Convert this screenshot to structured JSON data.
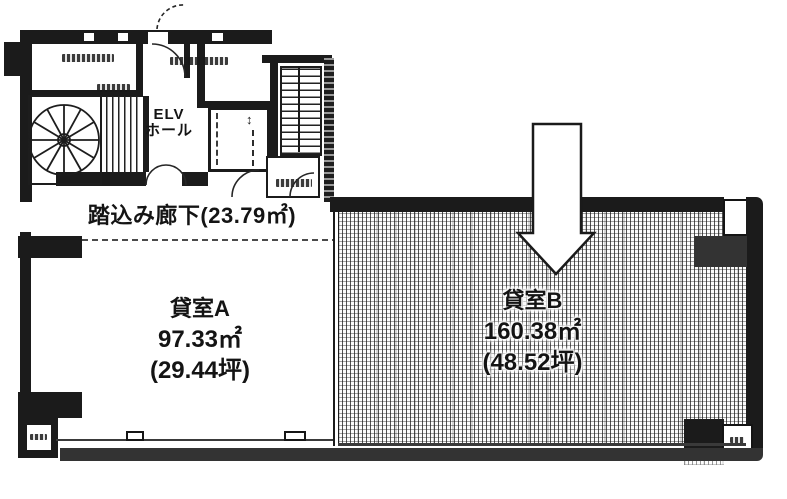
{
  "floorplan": {
    "core": {
      "elv_hall_line1": "ELV",
      "elv_hall_line2": "ホール",
      "elevator_symbol": "↕"
    },
    "corridor": {
      "label": "踏込み廊下(23.79㎡)"
    },
    "rooms": [
      {
        "id": "A",
        "name": "貸室A",
        "area_m2": "97.33㎡",
        "area_tsubo": "(29.44坪)"
      },
      {
        "id": "B",
        "name": "貸室B",
        "area_m2": "160.38㎡",
        "area_tsubo": "(48.52坪)"
      }
    ],
    "colors": {
      "ink": "#1b1b1b",
      "wall_gray": "#333333",
      "paper": "#ffffff"
    }
  }
}
